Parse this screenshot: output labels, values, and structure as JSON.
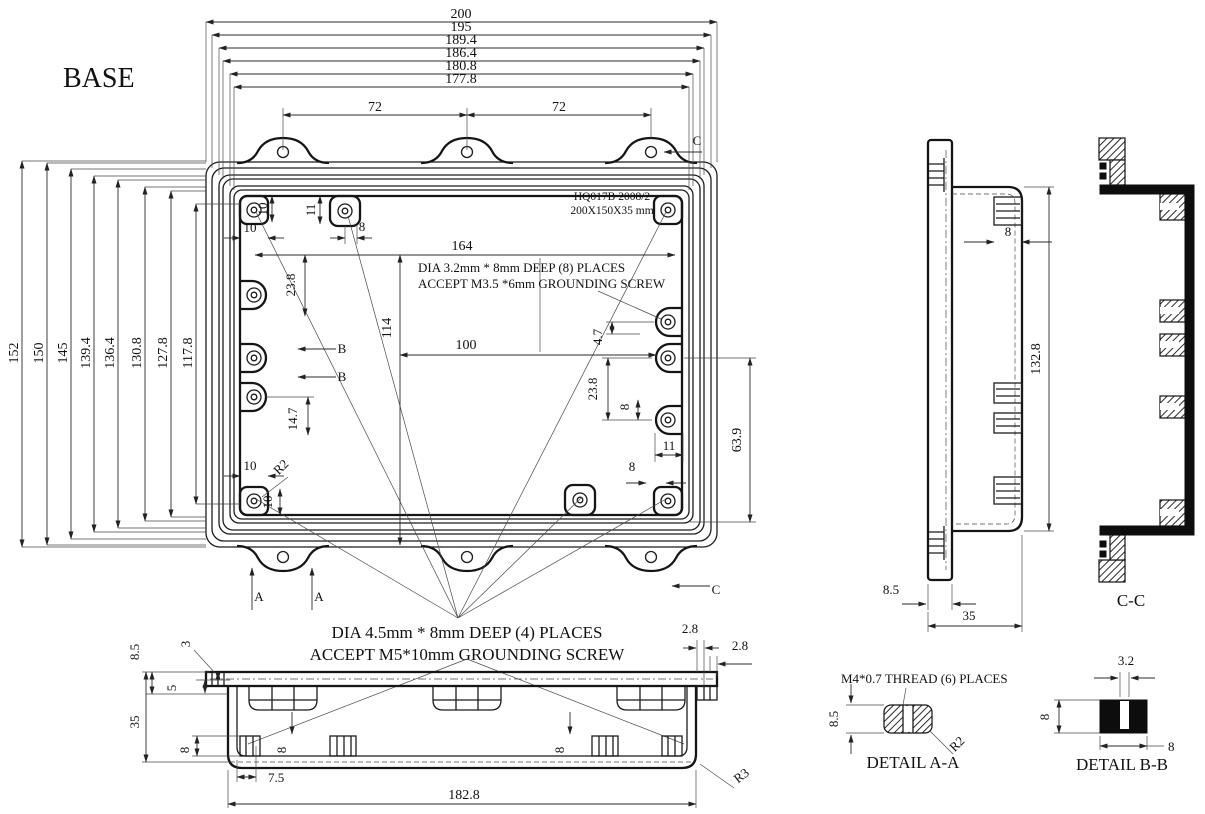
{
  "title": "BASE",
  "colors": {
    "ink": "#1a1a1a",
    "paper": "#ffffff"
  },
  "plan": {
    "top_dims": [
      "200",
      "195",
      "189.4",
      "186.4",
      "180.8",
      "177.8"
    ],
    "ear_dim_left": "72",
    "ear_dim_right": "72",
    "left_dims": [
      "152",
      "150",
      "145",
      "139.4",
      "136.4",
      "130.8",
      "127.8",
      "117.8"
    ],
    "part_no": "HQ017B 2008/2",
    "part_size": "200X150X35 mm",
    "note8_1": "DIA 3.2mm * 8mm DEEP (8) PLACES",
    "note8_2": "ACCEPT M3.5 *6mm GROUNDING SCREW",
    "note4_1": "DIA 4.5mm * 8mm DEEP (4) PLACES",
    "note4_2": "ACCEPT M5*10mm GROUNDING SCREW",
    "d164": "164",
    "d114": "114",
    "d100": "100",
    "d10_boss": "10",
    "d11_boss": "11",
    "d8_top": "8",
    "d10_w": "10",
    "d23_8_left": "23.8",
    "d14_7": "14.7",
    "d10_w2": "10",
    "r2": "R2",
    "d10_boss2": "10",
    "d4_7": "4.7",
    "d23_8_right": "23.8",
    "d8_right": "8",
    "d11_right": "11",
    "d63_9": "63.9",
    "d8_corner": "8",
    "sec_a": "A",
    "sec_b": "B",
    "sec_c": "C"
  },
  "front": {
    "d8_5": "8.5",
    "d3": "3",
    "d5": "5",
    "d35": "35",
    "d8_out": "8",
    "d8_in1": "8",
    "d8_in2": "8",
    "d7_5": "7.5",
    "d182_8": "182.8",
    "d2_8a": "2.8",
    "d2_8b": "2.8",
    "r3": "R3"
  },
  "side": {
    "d8": "8",
    "d132_8": "132.8",
    "d8_5": "8.5",
    "d35": "35"
  },
  "cc": {
    "label": "C-C"
  },
  "detail_a": {
    "note": "M4*0.7 THREAD (6) PLACES",
    "d8_5": "8.5",
    "r2": "R2",
    "label": "DETAIL A-A"
  },
  "detail_b": {
    "d3_2": "3.2",
    "d8_left": "8",
    "d8_bottom": "8",
    "label": "DETAIL B-B"
  }
}
